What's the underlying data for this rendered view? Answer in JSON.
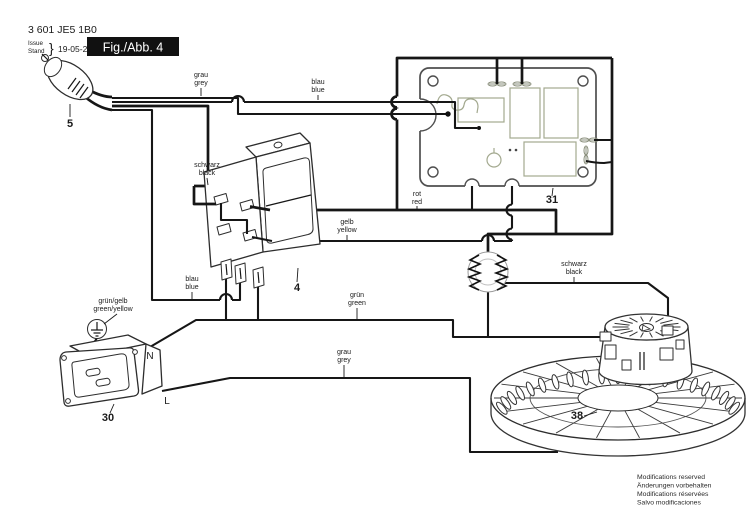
{
  "header": {
    "part_number": "3 601 JE5 1B0",
    "issue_label": "Issue",
    "stand_label": "Stand",
    "brace": "}",
    "date": "19-05-29",
    "figure_label": "Fig./Abb. 4"
  },
  "wire_labels": [
    {
      "de": "grau",
      "en": "grey",
      "x": 201,
      "y": 77,
      "lx1": 201,
      "ly1": 88,
      "lx2": 201,
      "ly2": 96
    },
    {
      "de": "blau",
      "en": "blue",
      "x": 318,
      "y": 84,
      "lx1": 318,
      "ly1": 95,
      "lx2": 318,
      "ly2": 100
    },
    {
      "de": "schwarz",
      "en": "black",
      "x": 207,
      "y": 167,
      "lx1": 207,
      "ly1": 178,
      "lx2": 208,
      "ly2": 185
    },
    {
      "de": "rot",
      "en": "red",
      "x": 417,
      "y": 196,
      "lx1": 417,
      "ly1": 206,
      "lx2": 417,
      "ly2": 209
    },
    {
      "de": "gelb",
      "en": "yellow",
      "x": 347,
      "y": 224,
      "lx1": 347,
      "ly1": 235,
      "lx2": 347,
      "ly2": 240
    },
    {
      "de": "blau",
      "en": "blue",
      "x": 192,
      "y": 281,
      "lx1": 192,
      "ly1": 292,
      "lx2": 192,
      "ly2": 299
    },
    {
      "de": "grün",
      "en": "green",
      "x": 357,
      "y": 297,
      "lx1": 357,
      "ly1": 308,
      "lx2": 357,
      "ly2": 319
    },
    {
      "de": "grün/gelb",
      "en": "green/yellow",
      "x": 113,
      "y": 303,
      "lx1": 117,
      "ly1": 314,
      "lx2": 104,
      "ly2": 324
    },
    {
      "de": "grau",
      "en": "grey",
      "x": 344,
      "y": 354,
      "lx1": 344,
      "ly1": 365,
      "lx2": 344,
      "ly2": 377
    },
    {
      "de": "schwarz",
      "en": "black",
      "x": 574,
      "y": 266,
      "lx1": 574,
      "ly1": 277,
      "lx2": 574,
      "ly2": 282
    }
  ],
  "callouts": [
    {
      "num": "5",
      "x": 70,
      "y": 127,
      "lx1": 70,
      "ly1": 104,
      "lx2": 70,
      "ly2": 117
    },
    {
      "num": "4",
      "x": 297,
      "y": 291,
      "lx1": 298,
      "ly1": 268,
      "lx2": 297,
      "ly2": 282
    },
    {
      "num": "31",
      "x": 552,
      "y": 203,
      "lx1": 553,
      "ly1": 188,
      "lx2": 552,
      "ly2": 196
    },
    {
      "num": "30",
      "x": 108,
      "y": 421,
      "lx1": 114,
      "ly1": 404,
      "lx2": 110,
      "ly2": 413
    },
    {
      "num": "38",
      "x": 577,
      "y": 419,
      "lx1": 584,
      "ly1": 416,
      "lx2": 597,
      "ly2": 412
    }
  ],
  "terminal_labels": {
    "n": "N",
    "l": "L"
  },
  "footer": {
    "lines": [
      "Modifications reserved",
      "Änderungen vorbehalten",
      "Modifications réservées",
      "Salvo modificaciones"
    ]
  },
  "colors": {
    "wire": "#161616",
    "pcb_edge": "#4f4f4f",
    "pcb_trace": "#a3a98f",
    "figure_box": "#111111",
    "label_text": "#1a1a1a"
  }
}
